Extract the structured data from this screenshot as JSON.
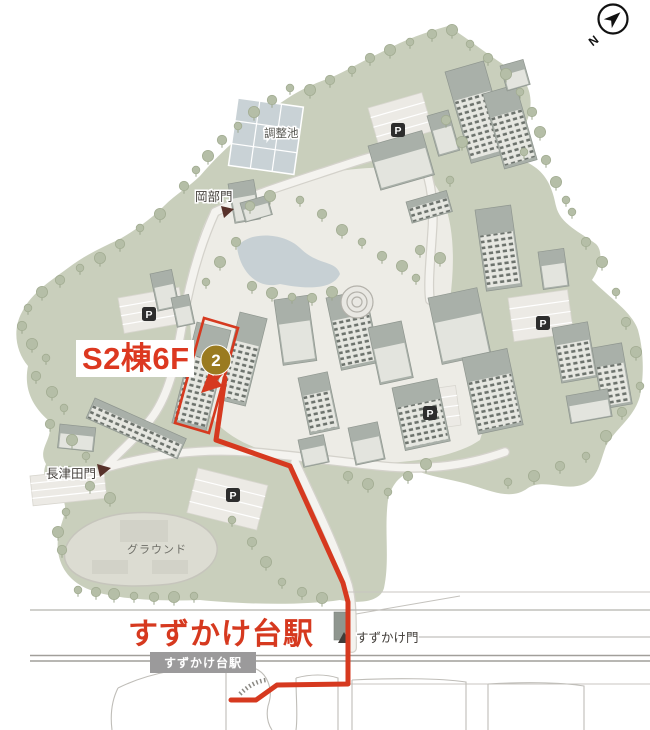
{
  "map": {
    "destination_label": "S2棟6F",
    "marker_number": "2",
    "station_label_large": "すずかけ台駅",
    "station_platform_label": "すずかけ台駅",
    "gate_okabe": "岡部門",
    "gate_nagatsuta": "長津田門",
    "gate_suzukake": "すずかけ門",
    "pond_label": "調整池",
    "ground_label": "グラウンド",
    "parking_letter": "P",
    "compass_letter": "N",
    "route": {
      "from": "すずかけ台駅",
      "to": "S2棟6F",
      "color": "#d6391f",
      "waypoints": [
        [
          231,
          700
        ],
        [
          256,
          700
        ],
        [
          277,
          685
        ],
        [
          348,
          684
        ],
        [
          348,
          602
        ],
        [
          343,
          583
        ],
        [
          290,
          466
        ],
        [
          216,
          440
        ],
        [
          225,
          378
        ]
      ]
    },
    "colors": {
      "campus_green": "#c9cfbc",
      "green_dark": "#bdc5af",
      "campus_core": "#edece6",
      "building_roof": "#a9b0a9",
      "water": "#c9d2d6",
      "accent_red": "#d6391f",
      "marker_gold": "#9a7b20",
      "station_bar": "#9b9a9b"
    }
  }
}
